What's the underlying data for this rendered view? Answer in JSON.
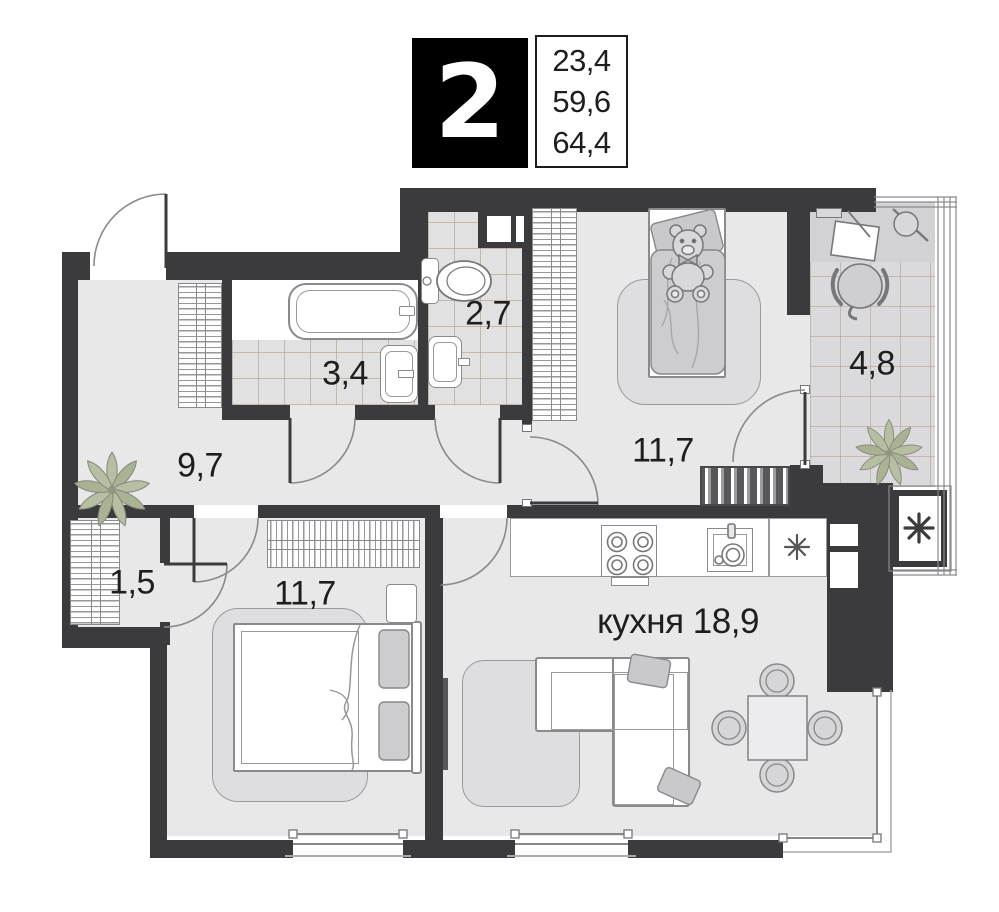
{
  "header": {
    "rooms_count": "2",
    "stats": [
      "23,4",
      "59,6",
      "64,4"
    ]
  },
  "rooms": {
    "bathroom": {
      "label": "3,4"
    },
    "wc": {
      "label": "2,7"
    },
    "hallway": {
      "label": "9,7"
    },
    "closet": {
      "label": "1,5"
    },
    "bedroom_child": {
      "label": "11,7"
    },
    "balcony": {
      "label": "4,8"
    },
    "bedroom_master": {
      "label": "11,7"
    },
    "kitchen": {
      "label": "кухня 18,9"
    }
  },
  "icons": {
    "fridge": "asterisk-icon",
    "ac_unit": "asterisk-icon",
    "plants": "palm-plant-icon",
    "toy": "teddy-bear-icon"
  },
  "colors": {
    "wall": "#3b3b3d",
    "floor": "#e8e8e9",
    "tile": "#e1e1e2",
    "tile_balcony": "#dadadc",
    "desk_floor": "#d2d2d4",
    "line": "#8a8a8c",
    "dark": "#58585a",
    "text": "#1e1e1e",
    "plant": "#b3bc9e",
    "rug": "#dedee0",
    "soft": "#cdcdcf"
  }
}
